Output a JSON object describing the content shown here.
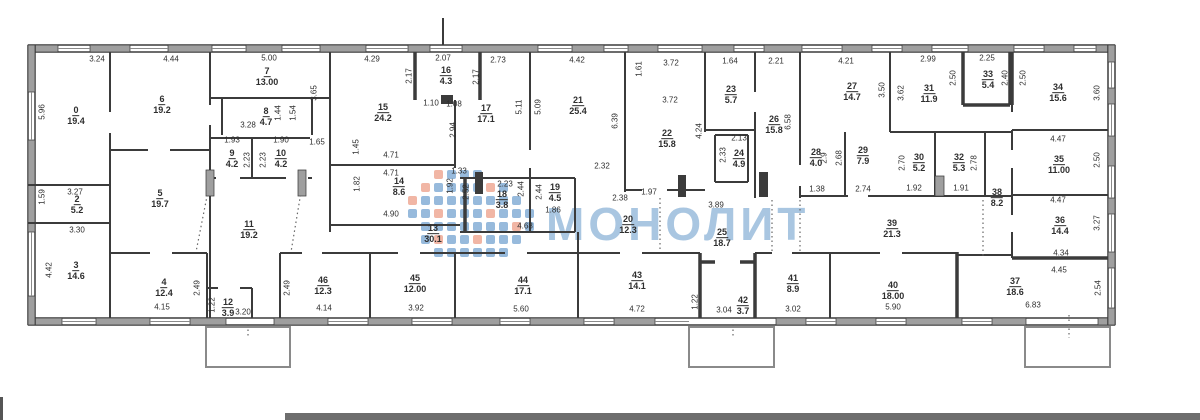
{
  "watermark": {
    "text": "МОНОЛИТ",
    "text_color": "#a9c6e1",
    "logo_blue": "#8cb2d8",
    "logo_red": "#efae9b",
    "logo_pattern": [
      "..rbbb....",
      ".rbbbbrb..",
      "rbbbbbbbb.",
      "bbrbbbrbbb",
      ".bbbbbbbrb",
      ".brbbrbbb.",
      "..bbbbbb.."
    ]
  },
  "rooms": [
    {
      "n": "0",
      "a": "19.4",
      "x": 76,
      "y": 116
    },
    {
      "n": "6",
      "a": "19.2",
      "x": 162,
      "y": 105
    },
    {
      "n": "7",
      "a": "13.00",
      "x": 267,
      "y": 77
    },
    {
      "n": "8",
      "a": "4.7",
      "x": 266,
      "y": 117
    },
    {
      "n": "9",
      "a": "4.2",
      "x": 232,
      "y": 159
    },
    {
      "n": "10",
      "a": "4.2",
      "x": 281,
      "y": 159
    },
    {
      "n": "2",
      "a": "5.2",
      "x": 77,
      "y": 205
    },
    {
      "n": "5",
      "a": "19.7",
      "x": 160,
      "y": 199
    },
    {
      "n": "3",
      "a": "14.6",
      "x": 76,
      "y": 271
    },
    {
      "n": "11",
      "a": "19.2",
      "x": 249,
      "y": 230
    },
    {
      "n": "4",
      "a": "12.4",
      "x": 164,
      "y": 288
    },
    {
      "n": "12",
      "a": "3.9",
      "x": 228,
      "y": 308
    },
    {
      "n": "46",
      "a": "12.3",
      "x": 323,
      "y": 286
    },
    {
      "n": "45",
      "a": "12.00",
      "x": 415,
      "y": 284
    },
    {
      "n": "44",
      "a": "17.1",
      "x": 523,
      "y": 286
    },
    {
      "n": "13",
      "a": "30.1",
      "x": 433,
      "y": 234
    },
    {
      "n": "15",
      "a": "24.2",
      "x": 383,
      "y": 113
    },
    {
      "n": "16",
      "a": "4.3",
      "x": 446,
      "y": 76
    },
    {
      "n": "17",
      "a": "17.1",
      "x": 486,
      "y": 114
    },
    {
      "n": "14",
      "a": "8.6",
      "x": 399,
      "y": 187
    },
    {
      "n": "18",
      "a": "3.8",
      "x": 502,
      "y": 200
    },
    {
      "n": "19",
      "a": "4.5",
      "x": 555,
      "y": 193
    },
    {
      "n": "21",
      "a": "25.4",
      "x": 578,
      "y": 106
    },
    {
      "n": "22",
      "a": "15.8",
      "x": 667,
      "y": 139
    },
    {
      "n": "23",
      "a": "5.7",
      "x": 731,
      "y": 95
    },
    {
      "n": "24",
      "a": "4.9",
      "x": 739,
      "y": 159
    },
    {
      "n": "26",
      "a": "15.8",
      "x": 774,
      "y": 125
    },
    {
      "n": "20",
      "a": "12.3",
      "x": 628,
      "y": 225
    },
    {
      "n": "25",
      "a": "18.7",
      "x": 722,
      "y": 238
    },
    {
      "n": "27",
      "a": "14.7",
      "x": 852,
      "y": 92
    },
    {
      "n": "28",
      "a": "4.0",
      "x": 816,
      "y": 158
    },
    {
      "n": "29",
      "a": "7.9",
      "x": 863,
      "y": 156
    },
    {
      "n": "30",
      "a": "5.2",
      "x": 919,
      "y": 163
    },
    {
      "n": "31",
      "a": "11.9",
      "x": 929,
      "y": 94
    },
    {
      "n": "32",
      "a": "5.3",
      "x": 959,
      "y": 163
    },
    {
      "n": "33",
      "a": "5.4",
      "x": 988,
      "y": 80
    },
    {
      "n": "34",
      "a": "15.6",
      "x": 1058,
      "y": 93
    },
    {
      "n": "35",
      "a": "11.00",
      "x": 1059,
      "y": 165
    },
    {
      "n": "36",
      "a": "14.4",
      "x": 1060,
      "y": 226
    },
    {
      "n": "37",
      "a": "18.6",
      "x": 1015,
      "y": 287
    },
    {
      "n": "38",
      "a": "8.2",
      "x": 997,
      "y": 198
    },
    {
      "n": "39",
      "a": "21.3",
      "x": 892,
      "y": 229
    },
    {
      "n": "40",
      "a": "18.00",
      "x": 893,
      "y": 291
    },
    {
      "n": "41",
      "a": "8.9",
      "x": 793,
      "y": 284
    },
    {
      "n": "42",
      "a": "3.7",
      "x": 743,
      "y": 306
    },
    {
      "n": "43",
      "a": "14.1",
      "x": 637,
      "y": 281
    }
  ],
  "dims": [
    {
      "t": "3.24",
      "x": 97,
      "y": 59
    },
    {
      "t": "4.44",
      "x": 171,
      "y": 59
    },
    {
      "t": "5.00",
      "x": 269,
      "y": 58
    },
    {
      "t": "4.29",
      "x": 372,
      "y": 59
    },
    {
      "t": "2.07",
      "x": 443,
      "y": 58
    },
    {
      "t": "2.73",
      "x": 498,
      "y": 60
    },
    {
      "t": "4.42",
      "x": 577,
      "y": 60
    },
    {
      "t": "3.72",
      "x": 671,
      "y": 63
    },
    {
      "t": "1.64",
      "x": 730,
      "y": 61
    },
    {
      "t": "2.21",
      "x": 776,
      "y": 61
    },
    {
      "t": "4.21",
      "x": 846,
      "y": 61
    },
    {
      "t": "2.99",
      "x": 928,
      "y": 59
    },
    {
      "t": "2.25",
      "x": 987,
      "y": 58
    },
    {
      "t": "2.17",
      "x": 409,
      "y": 76,
      "v": 1
    },
    {
      "t": "2.17",
      "x": 476,
      "y": 77,
      "v": 1
    },
    {
      "t": "1.61",
      "x": 639,
      "y": 69,
      "v": 1
    },
    {
      "t": "3.72",
      "x": 670,
      "y": 100
    },
    {
      "t": "1.10",
      "x": 431,
      "y": 103
    },
    {
      "t": "1.08",
      "x": 454,
      "y": 104
    },
    {
      "t": "5.96",
      "x": 42,
      "y": 112,
      "v": 1
    },
    {
      "t": "3.65",
      "x": 314,
      "y": 93,
      "v": 1
    },
    {
      "t": "3.28",
      "x": 248,
      "y": 125
    },
    {
      "t": "1.44",
      "x": 278,
      "y": 113,
      "v": 1
    },
    {
      "t": "1.54",
      "x": 293,
      "y": 113,
      "v": 1
    },
    {
      "t": "1.93",
      "x": 232,
      "y": 140
    },
    {
      "t": "1.90",
      "x": 281,
      "y": 140
    },
    {
      "t": "1.65",
      "x": 317,
      "y": 142
    },
    {
      "t": "2.23",
      "x": 247,
      "y": 160,
      "v": 1
    },
    {
      "t": "2.23",
      "x": 263,
      "y": 160,
      "v": 1
    },
    {
      "t": "3.27",
      "x": 75,
      "y": 192
    },
    {
      "t": "1.59",
      "x": 42,
      "y": 197,
      "v": 1
    },
    {
      "t": "3.30",
      "x": 77,
      "y": 230
    },
    {
      "t": "4.42",
      "x": 49,
      "y": 270,
      "v": 1
    },
    {
      "t": "1.45",
      "x": 356,
      "y": 147,
      "v": 1
    },
    {
      "t": "4.71",
      "x": 391,
      "y": 155
    },
    {
      "t": "4.71",
      "x": 391,
      "y": 173
    },
    {
      "t": "1.82",
      "x": 357,
      "y": 184,
      "v": 1
    },
    {
      "t": "1.33",
      "x": 459,
      "y": 171
    },
    {
      "t": "1.92",
      "x": 450,
      "y": 186,
      "v": 1
    },
    {
      "t": "4.90",
      "x": 391,
      "y": 214
    },
    {
      "t": "2.94",
      "x": 453,
      "y": 130,
      "v": 1
    },
    {
      "t": "5.11",
      "x": 519,
      "y": 107,
      "v": 1
    },
    {
      "t": "5.09",
      "x": 538,
      "y": 107,
      "v": 1
    },
    {
      "t": "6.39",
      "x": 615,
      "y": 121,
      "v": 1
    },
    {
      "t": "4.24",
      "x": 699,
      "y": 131,
      "v": 1
    },
    {
      "t": "2.52",
      "x": 466,
      "y": 192,
      "v": 1
    },
    {
      "t": "2.23",
      "x": 505,
      "y": 184
    },
    {
      "t": "2.44",
      "x": 521,
      "y": 189,
      "v": 1
    },
    {
      "t": "2.44",
      "x": 539,
      "y": 192,
      "v": 1
    },
    {
      "t": "1.86",
      "x": 553,
      "y": 210
    },
    {
      "t": "4.68",
      "x": 525,
      "y": 226
    },
    {
      "t": "2.32",
      "x": 602,
      "y": 166
    },
    {
      "t": "2.38",
      "x": 620,
      "y": 198
    },
    {
      "t": "1.97",
      "x": 649,
      "y": 192
    },
    {
      "t": "3.89",
      "x": 716,
      "y": 205
    },
    {
      "t": "2.13",
      "x": 739,
      "y": 138
    },
    {
      "t": "2.33",
      "x": 723,
      "y": 155,
      "v": 1
    },
    {
      "t": "6.58",
      "x": 788,
      "y": 122,
      "v": 1
    },
    {
      "t": "3.50",
      "x": 882,
      "y": 90,
      "v": 1
    },
    {
      "t": "3.62",
      "x": 901,
      "y": 93,
      "v": 1
    },
    {
      "t": "2.9",
      "x": 824,
      "y": 158,
      "v": 1
    },
    {
      "t": "2.68",
      "x": 839,
      "y": 158,
      "v": 1
    },
    {
      "t": "1.38",
      "x": 817,
      "y": 189
    },
    {
      "t": "2.74",
      "x": 863,
      "y": 189
    },
    {
      "t": "2.70",
      "x": 902,
      "y": 163,
      "v": 1
    },
    {
      "t": "1.92",
      "x": 914,
      "y": 188
    },
    {
      "t": "2.78",
      "x": 974,
      "y": 163,
      "v": 1
    },
    {
      "t": "1.91",
      "x": 961,
      "y": 188
    },
    {
      "t": "2.50",
      "x": 953,
      "y": 78,
      "v": 1
    },
    {
      "t": "2.40",
      "x": 1005,
      "y": 78,
      "v": 1
    },
    {
      "t": "2.50",
      "x": 1023,
      "y": 78,
      "v": 1
    },
    {
      "t": "3.60",
      "x": 1097,
      "y": 93,
      "v": 1
    },
    {
      "t": "4.47",
      "x": 1058,
      "y": 139
    },
    {
      "t": "2.50",
      "x": 1097,
      "y": 160,
      "v": 1
    },
    {
      "t": "4.47",
      "x": 1058,
      "y": 200
    },
    {
      "t": "3.27",
      "x": 1097,
      "y": 223,
      "v": 1
    },
    {
      "t": "4.34",
      "x": 1061,
      "y": 253
    },
    {
      "t": "4.45",
      "x": 1059,
      "y": 270
    },
    {
      "t": "2.54",
      "x": 1098,
      "y": 288,
      "v": 1
    },
    {
      "t": "6.83",
      "x": 1033,
      "y": 305
    },
    {
      "t": "2.49",
      "x": 197,
      "y": 288,
      "v": 1
    },
    {
      "t": "4.15",
      "x": 162,
      "y": 307
    },
    {
      "t": "1.22",
      "x": 212,
      "y": 305,
      "v": 1
    },
    {
      "t": "3.20",
      "x": 243,
      "y": 312
    },
    {
      "t": "2.49",
      "x": 287,
      "y": 288,
      "v": 1
    },
    {
      "t": "4.14",
      "x": 324,
      "y": 308
    },
    {
      "t": "3.92",
      "x": 416,
      "y": 308
    },
    {
      "t": "5.60",
      "x": 521,
      "y": 309
    },
    {
      "t": "4.72",
      "x": 637,
      "y": 309
    },
    {
      "t": "1.22",
      "x": 695,
      "y": 302,
      "v": 1
    },
    {
      "t": "3.04",
      "x": 724,
      "y": 310
    },
    {
      "t": "3.02",
      "x": 793,
      "y": 309
    },
    {
      "t": "5.90",
      "x": 893,
      "y": 307
    }
  ]
}
